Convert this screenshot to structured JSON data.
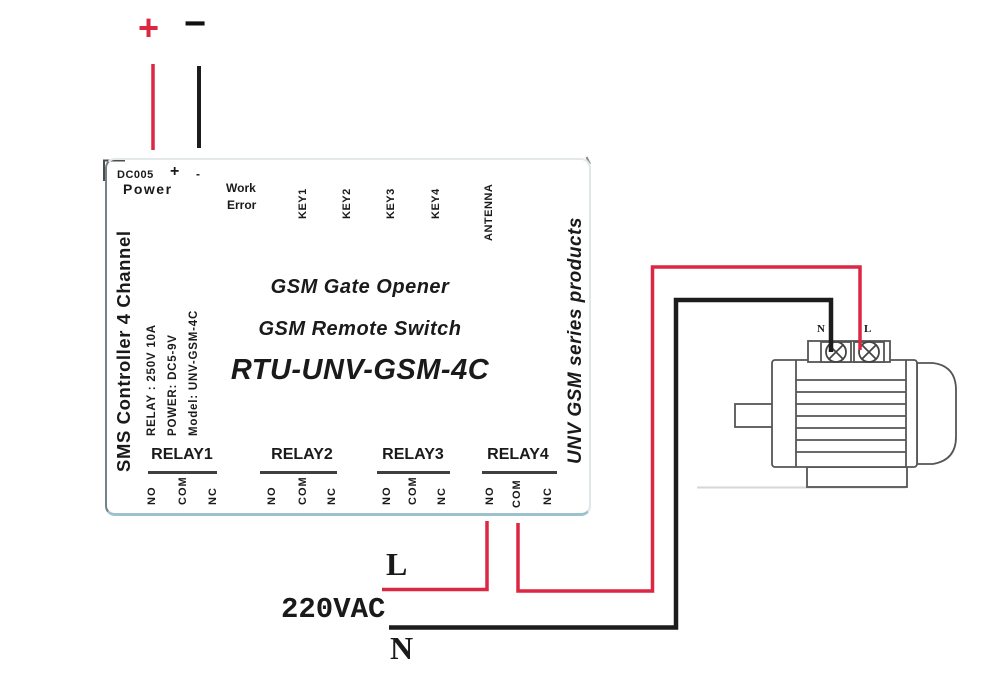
{
  "power_supply": {
    "positive": "+",
    "negative": "−"
  },
  "board": {
    "side_left_title": "SMS Controller 4 Channel",
    "side_right_title": "UNV GSM series products",
    "power_connector": {
      "label": "DC005",
      "plus": "+",
      "minus": "-",
      "name": "Power"
    },
    "status_leds": {
      "work": "Work",
      "error": "Error"
    },
    "keys": [
      "KEY1",
      "KEY2",
      "KEY3",
      "KEY4"
    ],
    "antenna": "ANTENNA",
    "specs": [
      "RELAY :  250V 10A",
      "POWER:  DC5-9V",
      "Model:  UNV-GSM-4C"
    ],
    "center_text": [
      "GSM Gate Opener",
      "GSM Remote Switch",
      "RTU-UNV-GSM-4C"
    ],
    "relays": [
      {
        "name": "RELAY1",
        "terminals": [
          "NO",
          "COM",
          "NC"
        ]
      },
      {
        "name": "RELAY2",
        "terminals": [
          "NO",
          "COM",
          "NC"
        ]
      },
      {
        "name": "RELAY3",
        "terminals": [
          "NO",
          "COM",
          "NC"
        ]
      },
      {
        "name": "RELAY4",
        "terminals": [
          "NO",
          "COM",
          "NC"
        ]
      }
    ]
  },
  "mains": {
    "live": "L",
    "voltage": "220VAC",
    "neutral": "N"
  },
  "motor": {
    "terminal_left": "N",
    "terminal_right": "L"
  },
  "colors": {
    "live_wire": "#dc2743",
    "neutral_wire": "#1c1c1c",
    "board_bottom_edge": "#9cc2cd",
    "relay_underline": "#3f3f3f",
    "motor_outline": "#555555"
  }
}
